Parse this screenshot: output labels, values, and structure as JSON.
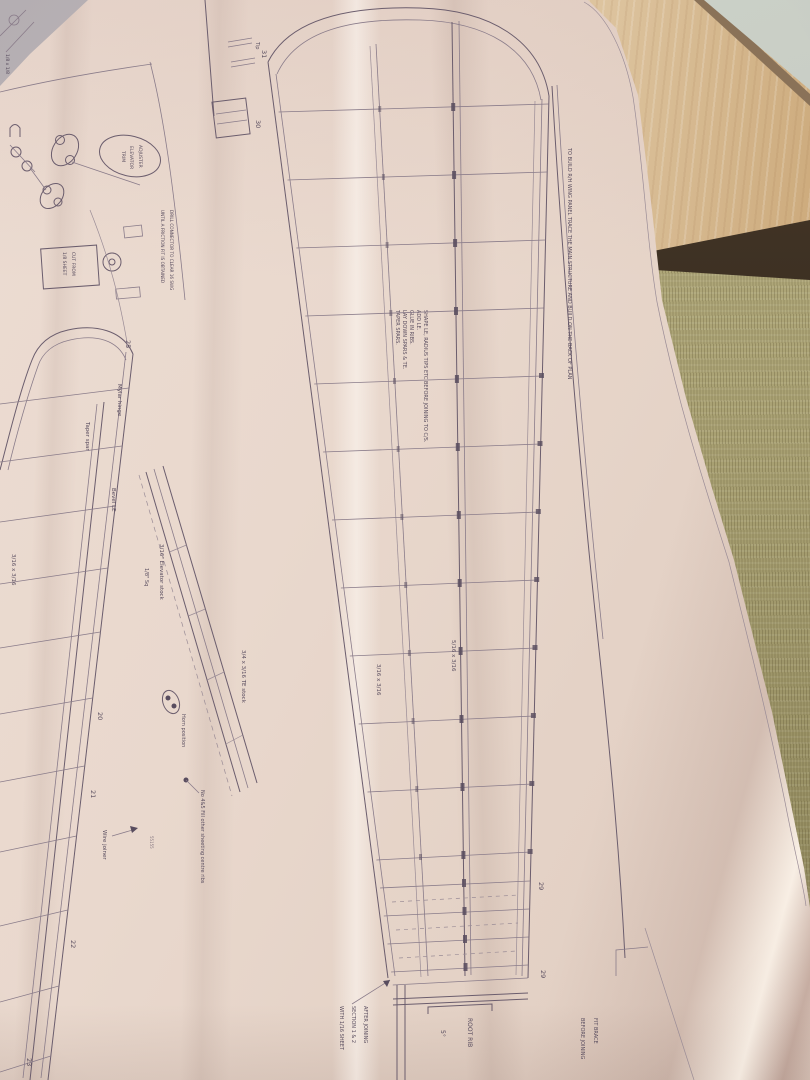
{
  "scene": {
    "description": "Photo of a model aircraft wing plan unrolled on tatami floor beside wooden beam",
    "materials": {
      "paper": "#ecdcd2",
      "ink": "#5a4e60",
      "wood_plank": "#d4b488",
      "wood_dark_edge": "#33291e",
      "tatami": "#a9a173",
      "wall": "#c7ccc3"
    }
  },
  "plan": {
    "border_note": "TO BUILD R/H WING PANEL TRACE THE MAIN STRUCTURE AND BUILD ON THE BACK OF PLAN",
    "build_steps": [
      "SHAPE LE, RADIUS TIPS ETC BEFORE JOINING TO C/S.",
      "ADD LE.",
      "GLUE IN RIBS.",
      "LAY DOWN SPARS & TE.",
      "TAPER SPARS."
    ],
    "labels": {
      "elevator_stock": "3/16\" Elevator stock",
      "eighth_sq": "1/8\" Sq",
      "te_stock": "3/4 x 3/16 TE stock",
      "horn_position": "Horn position",
      "sheeting_note": "No 4&5 Fill other sheeting centre ribs",
      "wire_joiner": "Wire joiner",
      "part_number": "55155",
      "mylar_hinge": "Mylar hinge",
      "taper_spar": "Taper spar",
      "bevel_le": "Bevel LE",
      "spar_516": "5/16 x 3/16",
      "spar_316": "3/16 x 3/16",
      "spar_316_left": "3/16 x 3/16",
      "stock_18": "1/8 x 1/8",
      "root_rib": "ROOT RIB",
      "root_angle": "5°",
      "after_join_1": "AFTER JOINING",
      "after_join_2": "SECTION 1 & 2",
      "after_join_3": "WITH 1/16 SHEET",
      "fit_brace_1": "FIT BRACE",
      "fit_brace_2": "BEFORE JOINING",
      "adjuster_1": "ADJUSTER",
      "adjuster_2": "ELEVATOR",
      "adjuster_3": "TRIM",
      "drill_note_1": "DRILL CONNECTOR TO CLEAR 16 SWG",
      "drill_note_2": "UNTIL A FRICTION FIT IS OBTAINED",
      "cut_from_1": "CUT FROM",
      "cut_from_2": "1/8 SHEET",
      "tip": "Tip"
    },
    "rib_numbers": {
      "big": [
        "31",
        "30",
        "29",
        "29"
      ],
      "left": [
        "25",
        "20",
        "21",
        "22",
        "23"
      ]
    }
  }
}
